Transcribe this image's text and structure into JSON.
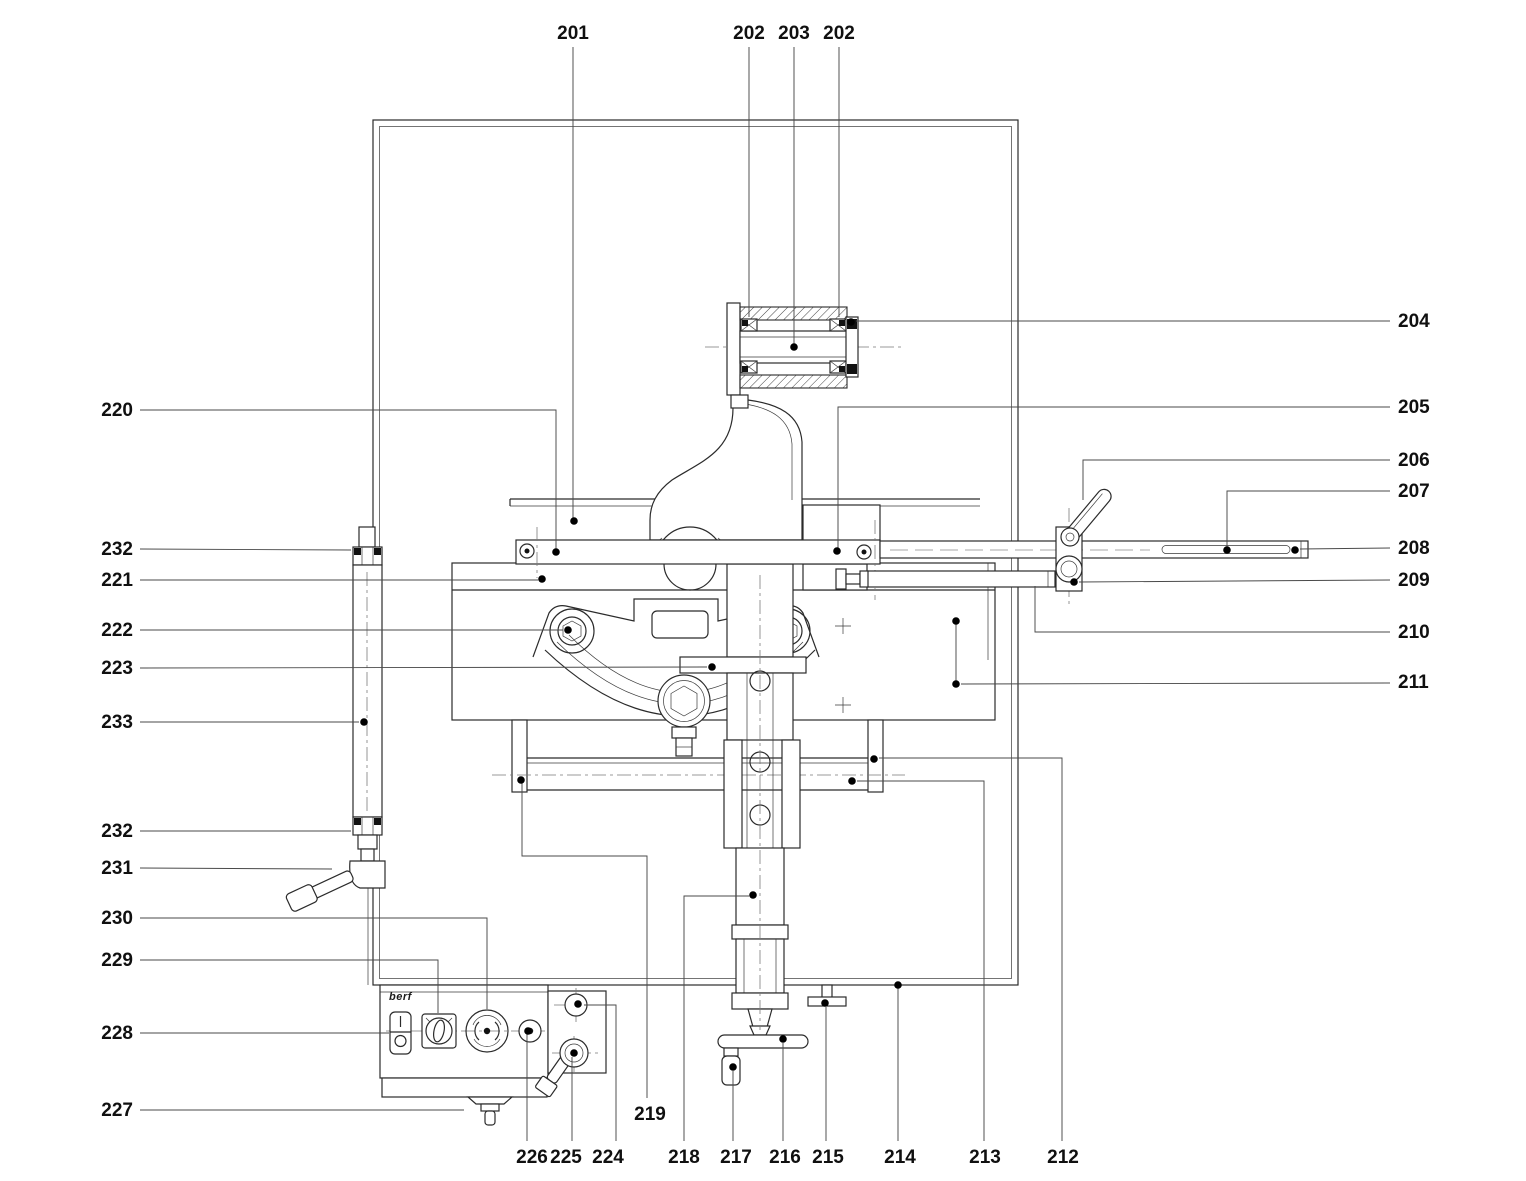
{
  "figure": {
    "background": "#ffffff",
    "line_color": "#2b2b2b",
    "leader_color": "#4a4a4a",
    "label_color": "#101010",
    "logo_text": "berf"
  },
  "callouts": [
    {
      "label": "201",
      "x": 573,
      "y": 33,
      "anchor": "middle",
      "leaders": [
        [
          [
            573,
            47
          ],
          [
            573,
            519
          ]
        ]
      ],
      "dots": [
        [
          574,
          521
        ]
      ]
    },
    {
      "label": "202",
      "x": 749,
      "y": 33,
      "anchor": "middle",
      "leaders": [
        [
          [
            749,
            47
          ],
          [
            749,
            317
          ]
        ]
      ],
      "dots": []
    },
    {
      "label": "203",
      "x": 794,
      "y": 33,
      "anchor": "middle",
      "leaders": [
        [
          [
            794,
            47
          ],
          [
            794,
            344
          ]
        ]
      ],
      "dots": [
        [
          794,
          347
        ]
      ]
    },
    {
      "label": "202",
      "x": 839,
      "y": 33,
      "anchor": "middle",
      "leaders": [
        [
          [
            839,
            47
          ],
          [
            839,
            317
          ]
        ]
      ],
      "dots": []
    },
    {
      "label": "204",
      "x": 1398,
      "y": 321,
      "anchor": "start",
      "leaders": [
        [
          [
            1390,
            321
          ],
          [
            856,
            321
          ]
        ]
      ],
      "dots": [
        [
          851,
          322
        ]
      ]
    },
    {
      "label": "205",
      "x": 1398,
      "y": 407,
      "anchor": "start",
      "leaders": [
        [
          [
            1390,
            407
          ],
          [
            838,
            407
          ],
          [
            838,
            549
          ]
        ]
      ],
      "dots": [
        [
          837,
          551
        ]
      ]
    },
    {
      "label": "206",
      "x": 1398,
      "y": 460,
      "anchor": "start",
      "leaders": [
        [
          [
            1390,
            460
          ],
          [
            1083,
            460
          ],
          [
            1083,
            500
          ]
        ]
      ],
      "dots": []
    },
    {
      "label": "207",
      "x": 1398,
      "y": 491,
      "anchor": "start",
      "leaders": [
        [
          [
            1390,
            491
          ],
          [
            1227,
            491
          ],
          [
            1227,
            547
          ]
        ]
      ],
      "dots": [
        [
          1227,
          550
        ]
      ]
    },
    {
      "label": "208",
      "x": 1398,
      "y": 548,
      "anchor": "start",
      "leaders": [
        [
          [
            1390,
            548
          ],
          [
            1300,
            549
          ]
        ]
      ],
      "dots": [
        [
          1295,
          550
        ]
      ]
    },
    {
      "label": "209",
      "x": 1398,
      "y": 580,
      "anchor": "start",
      "leaders": [
        [
          [
            1390,
            580
          ],
          [
            1079,
            582
          ]
        ]
      ],
      "dots": [
        [
          1074,
          582
        ]
      ]
    },
    {
      "label": "210",
      "x": 1398,
      "y": 632,
      "anchor": "start",
      "leaders": [
        [
          [
            1390,
            632
          ],
          [
            1035,
            632
          ],
          [
            1035,
            586
          ]
        ]
      ],
      "dots": []
    },
    {
      "label": "211",
      "x": 1398,
      "y": 682,
      "anchor": "start",
      "leaders": [
        [
          [
            1390,
            683
          ],
          [
            961,
            684
          ]
        ],
        [
          [
            956,
            684
          ],
          [
            956,
            621
          ]
        ]
      ],
      "dots": [
        [
          956,
          684
        ],
        [
          956,
          621
        ]
      ]
    },
    {
      "label": "220",
      "x": 133,
      "y": 410,
      "anchor": "end",
      "leaders": [
        [
          [
            140,
            410
          ],
          [
            556,
            410
          ],
          [
            556,
            549
          ]
        ]
      ],
      "dots": [
        [
          556,
          552
        ]
      ]
    },
    {
      "label": "232",
      "x": 133,
      "y": 549,
      "anchor": "end",
      "leaders": [
        [
          [
            140,
            549
          ],
          [
            351,
            550
          ]
        ]
      ],
      "dots": []
    },
    {
      "label": "221",
      "x": 133,
      "y": 580,
      "anchor": "end",
      "leaders": [
        [
          [
            140,
            580
          ],
          [
            538,
            580
          ]
        ]
      ],
      "dots": [
        [
          542,
          579
        ]
      ]
    },
    {
      "label": "222",
      "x": 133,
      "y": 630,
      "anchor": "end",
      "leaders": [
        [
          [
            140,
            630
          ],
          [
            563,
            630
          ]
        ]
      ],
      "dots": [
        [
          568,
          630
        ]
      ]
    },
    {
      "label": "223",
      "x": 133,
      "y": 668,
      "anchor": "end",
      "leaders": [
        [
          [
            140,
            668
          ],
          [
            707,
            667
          ]
        ]
      ],
      "dots": [
        [
          712,
          667
        ]
      ]
    },
    {
      "label": "233",
      "x": 133,
      "y": 722,
      "anchor": "end",
      "leaders": [
        [
          [
            140,
            722
          ],
          [
            359,
            722
          ]
        ]
      ],
      "dots": [
        [
          364,
          722
        ]
      ]
    },
    {
      "label": "232",
      "x": 133,
      "y": 831,
      "anchor": "end",
      "leaders": [
        [
          [
            140,
            831
          ],
          [
            351,
            831
          ]
        ]
      ],
      "dots": []
    },
    {
      "label": "231",
      "x": 133,
      "y": 868,
      "anchor": "end",
      "leaders": [
        [
          [
            140,
            868
          ],
          [
            332,
            869
          ]
        ]
      ],
      "dots": []
    },
    {
      "label": "230",
      "x": 133,
      "y": 918,
      "anchor": "end",
      "leaders": [
        [
          [
            140,
            918
          ],
          [
            487,
            918
          ],
          [
            487,
            1009
          ]
        ]
      ],
      "dots": []
    },
    {
      "label": "229",
      "x": 133,
      "y": 960,
      "anchor": "end",
      "leaders": [
        [
          [
            140,
            960
          ],
          [
            438,
            960
          ],
          [
            438,
            1013
          ]
        ]
      ],
      "dots": []
    },
    {
      "label": "228",
      "x": 133,
      "y": 1033,
      "anchor": "end",
      "leaders": [
        [
          [
            140,
            1033
          ],
          [
            389,
            1033
          ]
        ]
      ],
      "dots": []
    },
    {
      "label": "227",
      "x": 133,
      "y": 1110,
      "anchor": "end",
      "leaders": [
        [
          [
            140,
            1110
          ],
          [
            464,
            1110
          ]
        ]
      ],
      "dots": []
    },
    {
      "label": "226",
      "x": 532,
      "y": 1157,
      "anchor": "middle",
      "leaders": [
        [
          [
            527,
            1141
          ],
          [
            527,
            1034
          ]
        ]
      ],
      "dots": [
        [
          528,
          1031
        ]
      ]
    },
    {
      "label": "225",
      "x": 566,
      "y": 1157,
      "anchor": "middle",
      "leaders": [
        [
          [
            572,
            1141
          ],
          [
            572,
            1057
          ]
        ]
      ],
      "dots": [
        [
          574,
          1053
        ]
      ]
    },
    {
      "label": "224",
      "x": 608,
      "y": 1157,
      "anchor": "middle",
      "leaders": [
        [
          [
            616,
            1141
          ],
          [
            616,
            1005
          ],
          [
            584,
            1005
          ]
        ]
      ],
      "dots": [
        [
          578,
          1004
        ]
      ]
    },
    {
      "label": "219",
      "x": 650,
      "y": 1114,
      "anchor": "middle",
      "leaders": [
        [
          [
            647,
            1098
          ],
          [
            647,
            856
          ],
          [
            522,
            856
          ],
          [
            522,
            783
          ]
        ]
      ],
      "dots": [
        [
          521,
          780
        ]
      ]
    },
    {
      "label": "218",
      "x": 684,
      "y": 1157,
      "anchor": "middle",
      "leaders": [
        [
          [
            684,
            1141
          ],
          [
            684,
            896
          ],
          [
            749,
            896
          ]
        ]
      ],
      "dots": [
        [
          753,
          895
        ]
      ]
    },
    {
      "label": "217",
      "x": 736,
      "y": 1157,
      "anchor": "middle",
      "leaders": [
        [
          [
            733,
            1141
          ],
          [
            733,
            1071
          ]
        ]
      ],
      "dots": [
        [
          733,
          1067
        ]
      ]
    },
    {
      "label": "216",
      "x": 785,
      "y": 1157,
      "anchor": "middle",
      "leaders": [
        [
          [
            783,
            1141
          ],
          [
            783,
            1043
          ]
        ]
      ],
      "dots": [
        [
          783,
          1039
        ]
      ]
    },
    {
      "label": "215",
      "x": 828,
      "y": 1157,
      "anchor": "middle",
      "leaders": [
        [
          [
            826,
            1141
          ],
          [
            826,
            1007
          ]
        ]
      ],
      "dots": [
        [
          825,
          1003
        ]
      ]
    },
    {
      "label": "214",
      "x": 900,
      "y": 1157,
      "anchor": "middle",
      "leaders": [
        [
          [
            898,
            1141
          ],
          [
            898,
            988
          ]
        ]
      ],
      "dots": [
        [
          898,
          985
        ]
      ]
    },
    {
      "label": "213",
      "x": 985,
      "y": 1157,
      "anchor": "middle",
      "leaders": [
        [
          [
            984,
            1141
          ],
          [
            984,
            781
          ],
          [
            857,
            781
          ]
        ]
      ],
      "dots": [
        [
          852,
          781
        ]
      ]
    },
    {
      "label": "212",
      "x": 1063,
      "y": 1157,
      "anchor": "middle",
      "leaders": [
        [
          [
            1062,
            1141
          ],
          [
            1062,
            758
          ],
          [
            879,
            758
          ]
        ]
      ],
      "dots": [
        [
          874,
          759
        ]
      ]
    }
  ]
}
